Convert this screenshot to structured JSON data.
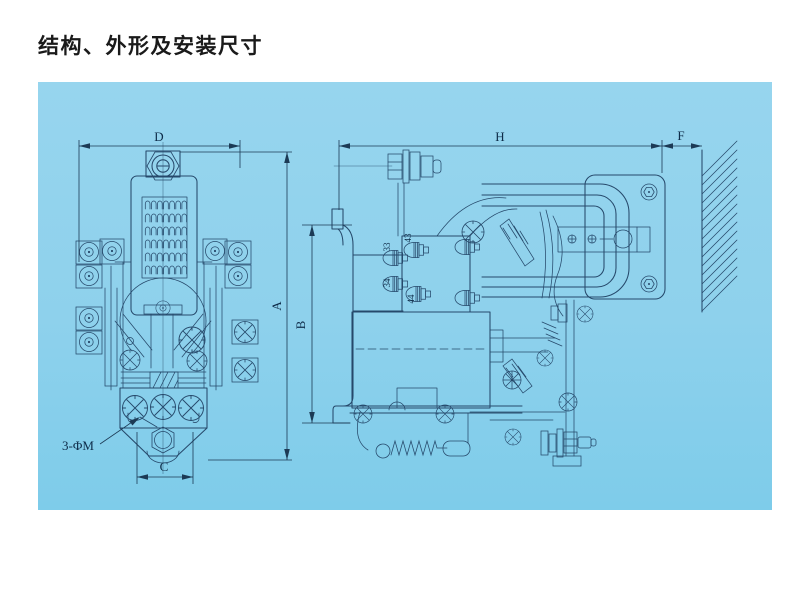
{
  "title": "结构、外形及安装尺寸",
  "colors": {
    "page_bg": "#ffffff",
    "panel_bg_top": "#97d5ee",
    "panel_bg_bottom": "#7eccea",
    "line": "#26496b",
    "label_text": "#0e2c49",
    "title_text": "#1a1a1a"
  },
  "front_view": {
    "dim_width_label": "D",
    "dim_height_label": "A",
    "dim_hole_span_label": "C",
    "mounting_holes_label": "3-ΦM"
  },
  "side_view": {
    "dim_depth_label": "H",
    "dim_wall_gap_label": "F",
    "dim_height_label": "B",
    "terminals": {
      "t43": "43",
      "t33": "33",
      "t34": "34",
      "t44": "44"
    }
  }
}
